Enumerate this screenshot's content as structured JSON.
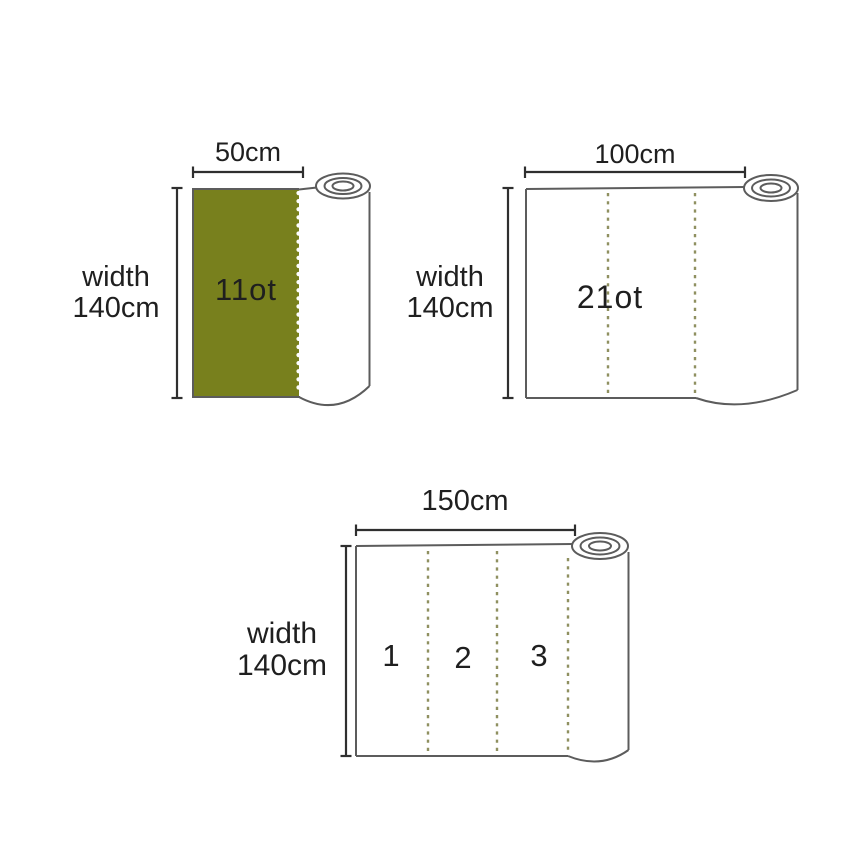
{
  "colors": {
    "background": "#ffffff",
    "fabric_green": "#78801d",
    "cut_dash": "#8f9060",
    "perforation_dot": "#ffffff",
    "outline_gray": "#5c5c5c",
    "measure_dark": "#2f2f2f",
    "label_text": "#1f1f1f"
  },
  "figures": [
    {
      "name": "roll-50cm",
      "top_label": "50cm",
      "side_label_top": "width",
      "side_label_bottom": "140cm",
      "area_label": "11ot"
    },
    {
      "name": "roll-100cm",
      "top_label": "100cm",
      "side_label_top": "width",
      "side_label_bottom": "140cm",
      "area_label": "21ot"
    },
    {
      "name": "roll-150cm",
      "top_label": "150cm",
      "side_label_top": "width",
      "side_label_bottom": "140cm",
      "segment_labels": [
        "1",
        "2",
        "3"
      ]
    }
  ]
}
